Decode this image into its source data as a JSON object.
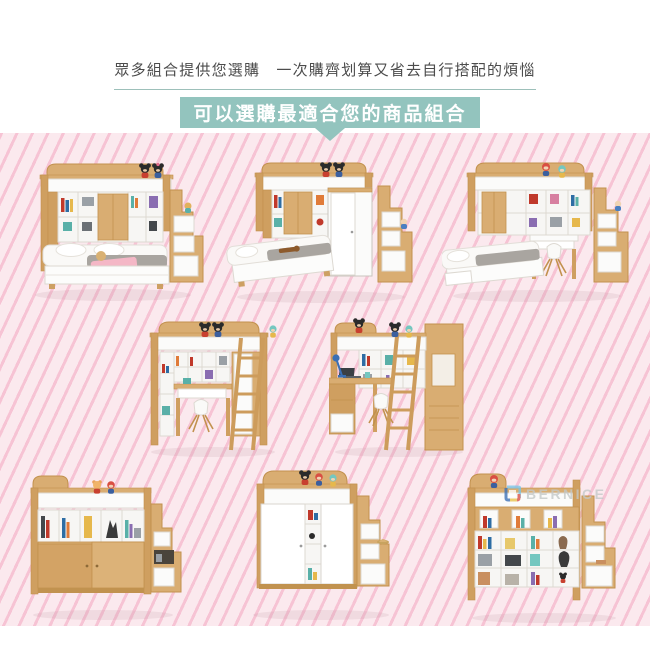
{
  "header": {
    "tagline": "眾多組合提供您選購　一次購齊划算又省去自行搭配的煩惱",
    "banner_label": "可以選購最適合您的商品組合"
  },
  "watermark": {
    "text": "BERNICE",
    "logo": "bernice-logo-icon"
  },
  "products": [
    {
      "name": "loft-bunk-with-double-bed-and-stair-chest"
    },
    {
      "name": "loft-bunk-with-single-bed-sliding-wardrobe-and-stair-chest"
    },
    {
      "name": "loft-bunk-with-single-bed-desk-chair-and-stair-chest"
    },
    {
      "name": "high-loft-bed-with-desk-wardrobe-and-ladder"
    },
    {
      "name": "high-loft-bed-with-l-shaped-desk-and-ladder"
    },
    {
      "name": "mid-loft-bed-with-bookcase-wood-sliding-doors-and-stair-chest"
    },
    {
      "name": "mid-loft-bed-with-white-sliding-wardrobe-and-stair-chest"
    },
    {
      "name": "mid-loft-bed-with-open-shelving-and-stair-chest"
    }
  ],
  "colors": {
    "accent_teal": "#93c4be",
    "underline_teal": "#9dc0ba",
    "background_pink": "#fbe9ee",
    "stripe_pink": "#f3a4be",
    "wood": "#d9ad72",
    "panel_white": "#fbfbfa",
    "text_dark": "#4c4c4c",
    "watermark_gray": "#c3c8c8"
  }
}
